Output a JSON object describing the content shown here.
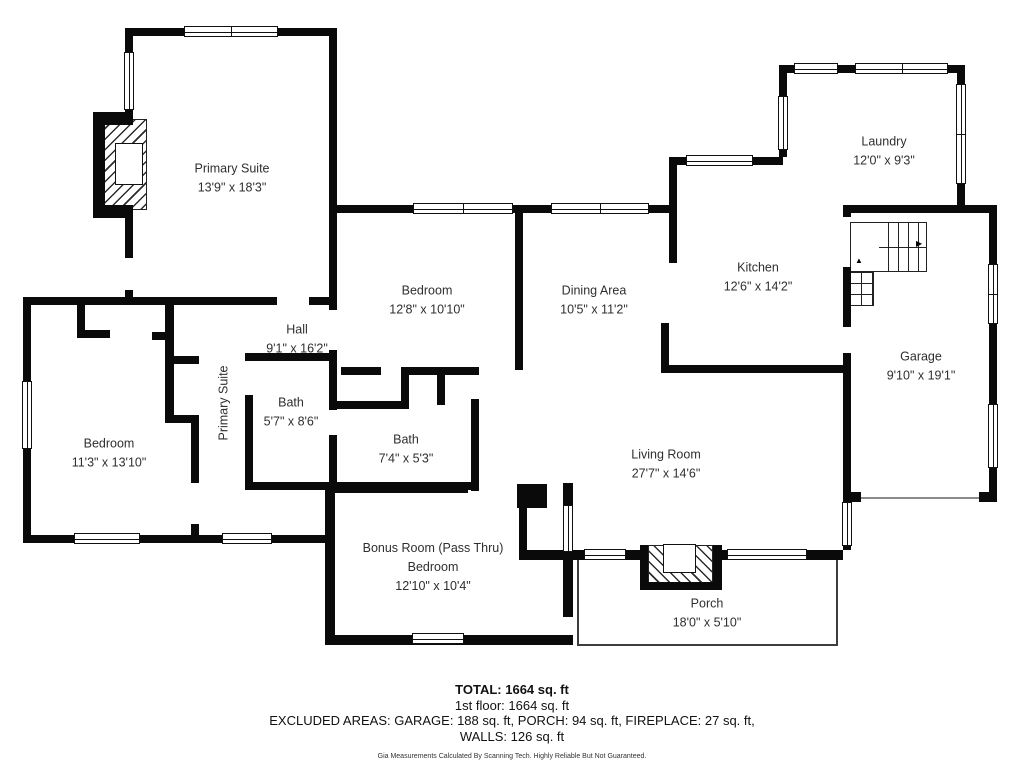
{
  "footer": {
    "total": "TOTAL: 1664 sq. ft",
    "floor": "1st floor: 1664 sq. ft",
    "excluded": "EXCLUDED AREAS: GARAGE: 188 sq. ft, PORCH: 94 sq. ft, FIREPLACE: 27 sq. ft,",
    "walls": "WALLS: 126 sq. ft",
    "disclaimer": "Gia Measurements Calculated By Scanning Tech. Highly Reliable But Not Guaranteed."
  },
  "floorplan": {
    "wall_color": "#0a0a0a",
    "rooms": [
      {
        "name": "Primary Suite",
        "dims": "13'9\" x 18'3\"",
        "cx": 232,
        "cy": 178
      },
      {
        "name": "Laundry",
        "dims": "12'0\" x 9'3\"",
        "cx": 884,
        "cy": 151
      },
      {
        "name": "Kitchen",
        "dims": "12'6\" x 14'2\"",
        "cx": 758,
        "cy": 277
      },
      {
        "name": "Bedroom",
        "dims": "12'8\" x 10'10\"",
        "cx": 427,
        "cy": 300
      },
      {
        "name": "Dining Area",
        "dims": "10'5\" x 11'2\"",
        "cx": 594,
        "cy": 300
      },
      {
        "name": "Hall",
        "dims": "9'1\" x 16'2\"",
        "cx": 297,
        "cy": 339
      },
      {
        "name": "Bath",
        "dims": "5'7\" x 8'6\"",
        "cx": 291,
        "cy": 412
      },
      {
        "name": "Bath",
        "dims": "7'4\" x 5'3\"",
        "cx": 406,
        "cy": 449
      },
      {
        "name": "Bedroom",
        "dims": "11'3\" x 13'10\"",
        "cx": 109,
        "cy": 453
      },
      {
        "name": "Garage",
        "dims": "9'10\" x 19'1\"",
        "cx": 921,
        "cy": 366
      },
      {
        "name": "Living Room",
        "dims": "27'7\" x 14'6\"",
        "cx": 666,
        "cy": 464
      },
      {
        "name": "Bonus Room (Pass Thru)",
        "name2": "Bedroom",
        "dims": "12'10\" x 10'4\"",
        "cx": 433,
        "cy": 567
      },
      {
        "name": "Porch",
        "dims": "18'0\" x 5'10\"",
        "cx": 707,
        "cy": 613
      },
      {
        "name": "Primary Suite",
        "vertical": true,
        "cx": 224,
        "cy": 403
      }
    ],
    "walls": [
      [
        125,
        28,
        212,
        8
      ],
      [
        125,
        28,
        8,
        230
      ],
      [
        125,
        290,
        8,
        15
      ],
      [
        329,
        28,
        8,
        282
      ],
      [
        23,
        297,
        254,
        8
      ],
      [
        309,
        297,
        28,
        8
      ],
      [
        23,
        297,
        8,
        246
      ],
      [
        23,
        535,
        312,
        8
      ],
      [
        77,
        303,
        8,
        34
      ],
      [
        77,
        330,
        33,
        8
      ],
      [
        165,
        304,
        9,
        115
      ],
      [
        152,
        332,
        15,
        8
      ],
      [
        169,
        356,
        30,
        8
      ],
      [
        165,
        415,
        34,
        8
      ],
      [
        191,
        415,
        8,
        68
      ],
      [
        191,
        524,
        8,
        19
      ],
      [
        245,
        353,
        92,
        8
      ],
      [
        245,
        395,
        8,
        95
      ],
      [
        245,
        482,
        234,
        8
      ],
      [
        329,
        350,
        8,
        60
      ],
      [
        329,
        435,
        8,
        55
      ],
      [
        337,
        205,
        340,
        8
      ],
      [
        515,
        205,
        8,
        165
      ],
      [
        341,
        367,
        40,
        8
      ],
      [
        401,
        367,
        78,
        8
      ],
      [
        401,
        375,
        8,
        30
      ],
      [
        437,
        375,
        8,
        30
      ],
      [
        337,
        401,
        72,
        8
      ],
      [
        471,
        399,
        8,
        92
      ],
      [
        669,
        157,
        8,
        106
      ],
      [
        661,
        323,
        8,
        50
      ],
      [
        661,
        365,
        190,
        8
      ],
      [
        677,
        157,
        106,
        8
      ],
      [
        779,
        65,
        186,
        8
      ],
      [
        779,
        65,
        8,
        92
      ],
      [
        957,
        65,
        8,
        148
      ],
      [
        843,
        205,
        154,
        8
      ],
      [
        989,
        205,
        8,
        297
      ],
      [
        843,
        205,
        8,
        12
      ],
      [
        843,
        267,
        8,
        60
      ],
      [
        843,
        353,
        8,
        149
      ],
      [
        843,
        492,
        18,
        10
      ],
      [
        979,
        492,
        18,
        10
      ],
      [
        843,
        492,
        8,
        58
      ],
      [
        573,
        550,
        70,
        10
      ],
      [
        722,
        550,
        121,
        10
      ],
      [
        325,
        483,
        143,
        10
      ],
      [
        517,
        484,
        30,
        24
      ],
      [
        519,
        507,
        8,
        45
      ],
      [
        519,
        550,
        54,
        10
      ],
      [
        563,
        483,
        10,
        26
      ],
      [
        563,
        550,
        10,
        67
      ],
      [
        325,
        483,
        10,
        162
      ],
      [
        325,
        635,
        248,
        10
      ]
    ],
    "windows": [
      {
        "r": [
          184,
          26,
          94,
          11
        ],
        "o": "h",
        "m": true
      },
      {
        "r": [
          124,
          52,
          10,
          58
        ],
        "o": "v"
      },
      {
        "r": [
          22,
          381,
          10,
          68
        ],
        "o": "v"
      },
      {
        "r": [
          74,
          533,
          66,
          11
        ],
        "o": "h"
      },
      {
        "r": [
          222,
          533,
          50,
          11
        ],
        "o": "h"
      },
      {
        "r": [
          413,
          203,
          100,
          11
        ],
        "o": "h",
        "m": true
      },
      {
        "r": [
          551,
          203,
          98,
          11
        ],
        "o": "h",
        "m": true
      },
      {
        "r": [
          686,
          155,
          67,
          11
        ],
        "o": "h"
      },
      {
        "r": [
          794,
          63,
          44,
          11
        ],
        "o": "h"
      },
      {
        "r": [
          855,
          63,
          93,
          11
        ],
        "o": "h",
        "m": true
      },
      {
        "r": [
          778,
          96,
          10,
          54
        ],
        "o": "v"
      },
      {
        "r": [
          956,
          84,
          10,
          100
        ],
        "o": "v",
        "m": true
      },
      {
        "r": [
          988,
          264,
          10,
          60
        ],
        "o": "v",
        "m": true
      },
      {
        "r": [
          988,
          404,
          10,
          64
        ],
        "o": "v"
      },
      {
        "r": [
          842,
          502,
          10,
          44
        ],
        "o": "v"
      },
      {
        "r": [
          584,
          549,
          42,
          11
        ],
        "o": "h"
      },
      {
        "r": [
          727,
          549,
          80,
          11
        ],
        "o": "h"
      },
      {
        "r": [
          412,
          633,
          52,
          11
        ],
        "o": "h"
      },
      {
        "r": [
          563,
          505,
          10,
          47
        ],
        "o": "v"
      }
    ],
    "porch": [
      577,
      556,
      261,
      90
    ],
    "fireplaces": [
      {
        "hatch": [
          103,
          119,
          44,
          91
        ],
        "dir": "ne",
        "frame": [
          [
            93,
            112,
            12,
            106
          ],
          [
            93,
            112,
            40,
            13
          ],
          [
            93,
            205,
            40,
            13
          ]
        ],
        "box": [
          115,
          143,
          28,
          42
        ]
      },
      {
        "hatch": [
          648,
          545,
          65,
          38
        ],
        "dir": "se",
        "frame": [
          [
            640,
            545,
            8,
            45
          ],
          [
            713,
            545,
            9,
            45
          ],
          [
            640,
            582,
            82,
            8
          ]
        ],
        "box": [
          663,
          544,
          33,
          29
        ]
      }
    ],
    "stair_big": {
      "r": [
        850,
        222,
        77,
        50
      ],
      "tread_left": 28
    },
    "stair_small": {
      "r": [
        850,
        272,
        24,
        34
      ]
    },
    "garage_door_line": [
      861,
      497,
      118,
      2
    ],
    "arrows": [
      {
        "ch": "▲",
        "x": 855,
        "y": 257
      },
      {
        "ch": "▶",
        "x": 916,
        "y": 240
      }
    ]
  }
}
